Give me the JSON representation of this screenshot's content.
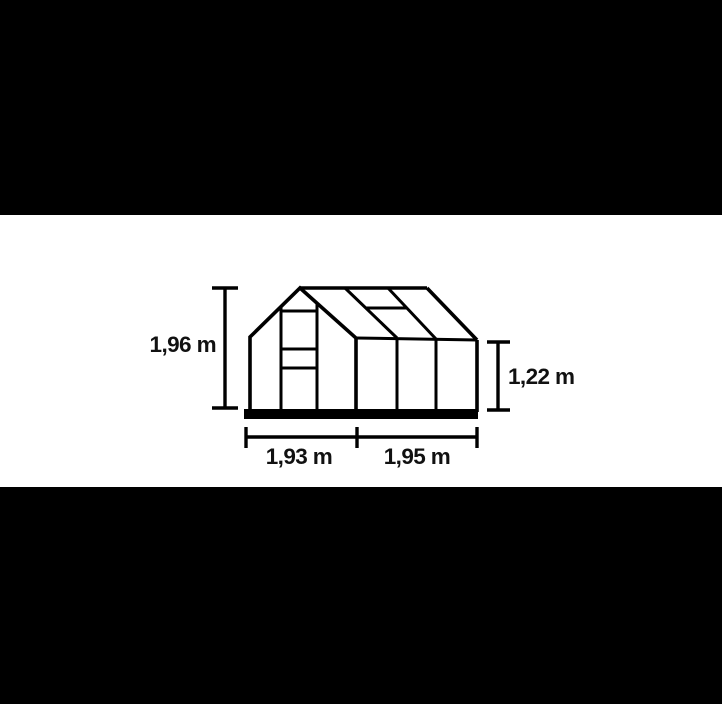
{
  "scene": {
    "description_label": "greenhouse-dimension-drawing",
    "letterbox_color": "#000000",
    "canvas_color": "#ffffff",
    "line_color": "#000000",
    "text_color": "#111111"
  },
  "dimensions": {
    "ridge_height": {
      "label": "1,96 m"
    },
    "eave_height": {
      "label": "1,22 m"
    },
    "front_width": {
      "label": "1,93 m"
    },
    "side_length": {
      "label": "1,95 m"
    }
  }
}
